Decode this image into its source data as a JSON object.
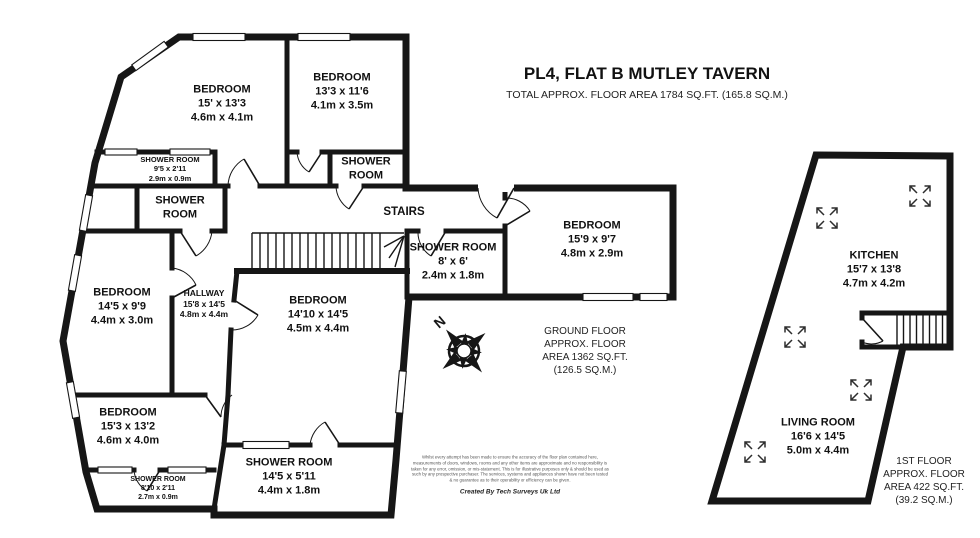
{
  "header": {
    "title": "PL4, FLAT B MUTLEY TAVERN",
    "subtitle": "TOTAL APPROX. FLOOR AREA 1784 SQ.FT. (165.8 SQ.M.)"
  },
  "labels": [
    {
      "id": "bedroom-1",
      "lines": [
        "BEDROOM",
        "15' x 13'3",
        "4.6m x 4.1m"
      ]
    },
    {
      "id": "bedroom-2",
      "lines": [
        "BEDROOM",
        "13'3 x 11'6",
        "4.1m x 3.5m"
      ]
    },
    {
      "id": "shower-room-1",
      "lines": [
        "SHOWER ROOM",
        "9'5 x 2'11",
        "2.9m x 0.9m"
      ]
    },
    {
      "id": "shower-room-2",
      "lines": [
        "SHOWER",
        "ROOM"
      ]
    },
    {
      "id": "shower-room-3",
      "lines": [
        "SHOWER",
        "ROOM"
      ]
    },
    {
      "id": "stairs",
      "lines": [
        "STAIRS"
      ]
    },
    {
      "id": "shower-room-4",
      "lines": [
        "SHOWER ROOM",
        "8' x 6'",
        "2.4m x 1.8m"
      ]
    },
    {
      "id": "bedroom-3",
      "lines": [
        "BEDROOM",
        "15'9 x 9'7",
        "4.8m x 2.9m"
      ]
    },
    {
      "id": "bedroom-4",
      "lines": [
        "BEDROOM",
        "14'5 x 9'9",
        "4.4m x 3.0m"
      ]
    },
    {
      "id": "hallway",
      "lines": [
        "HALLWAY",
        "15'8 x 14'5",
        "4.8m x 4.4m"
      ]
    },
    {
      "id": "bedroom-5",
      "lines": [
        "BEDROOM",
        "14'10 x 14'5",
        "4.5m x 4.4m"
      ]
    },
    {
      "id": "bedroom-6",
      "lines": [
        "BEDROOM",
        "15'3 x 13'2",
        "4.6m x 4.0m"
      ]
    },
    {
      "id": "shower-room-5",
      "lines": [
        "SHOWER ROOM",
        "8'10 x 2'11",
        "2.7m x 0.9m"
      ]
    },
    {
      "id": "shower-room-6",
      "lines": [
        "SHOWER ROOM",
        "14'5 x 5'11",
        "4.4m x 1.8m"
      ]
    },
    {
      "id": "kitchen",
      "lines": [
        "KITCHEN",
        "15'7 x 13'8",
        "4.7m x 4.2m"
      ]
    },
    {
      "id": "living-room",
      "lines": [
        "LIVING ROOM",
        "16'6 x 14'5",
        "5.0m x 4.4m"
      ]
    }
  ],
  "notes": {
    "ground": {
      "lines": [
        "GROUND FLOOR",
        "APPROX. FLOOR",
        "AREA 1362 SQ.FT.",
        "(126.5 SQ.M.)"
      ]
    },
    "first": {
      "lines": [
        "1ST FLOOR",
        "APPROX. FLOOR",
        "AREA 422 SQ.FT.",
        "(39.2 SQ.M.)"
      ]
    }
  },
  "compass": {
    "north": "N"
  },
  "footer": {
    "disclaimer": "Whilst every attempt has been made to ensure the accuracy of the floor plan contained here, measurements of doors, windows, rooms and any other items are approximate and no responsibility is taken for any error, omission, or mis-statement. This is for illustrative purposes only & should be used as such by any prospective purchaser. The services, systems and appliances shown have not been tested & no guarantee as to their operability or efficiency can be given.",
    "credit": "Created By Tech Surveys Uk Ltd"
  },
  "colors": {
    "wall": "#161616",
    "text": "#111111",
    "icon": "#2d2d2d"
  }
}
